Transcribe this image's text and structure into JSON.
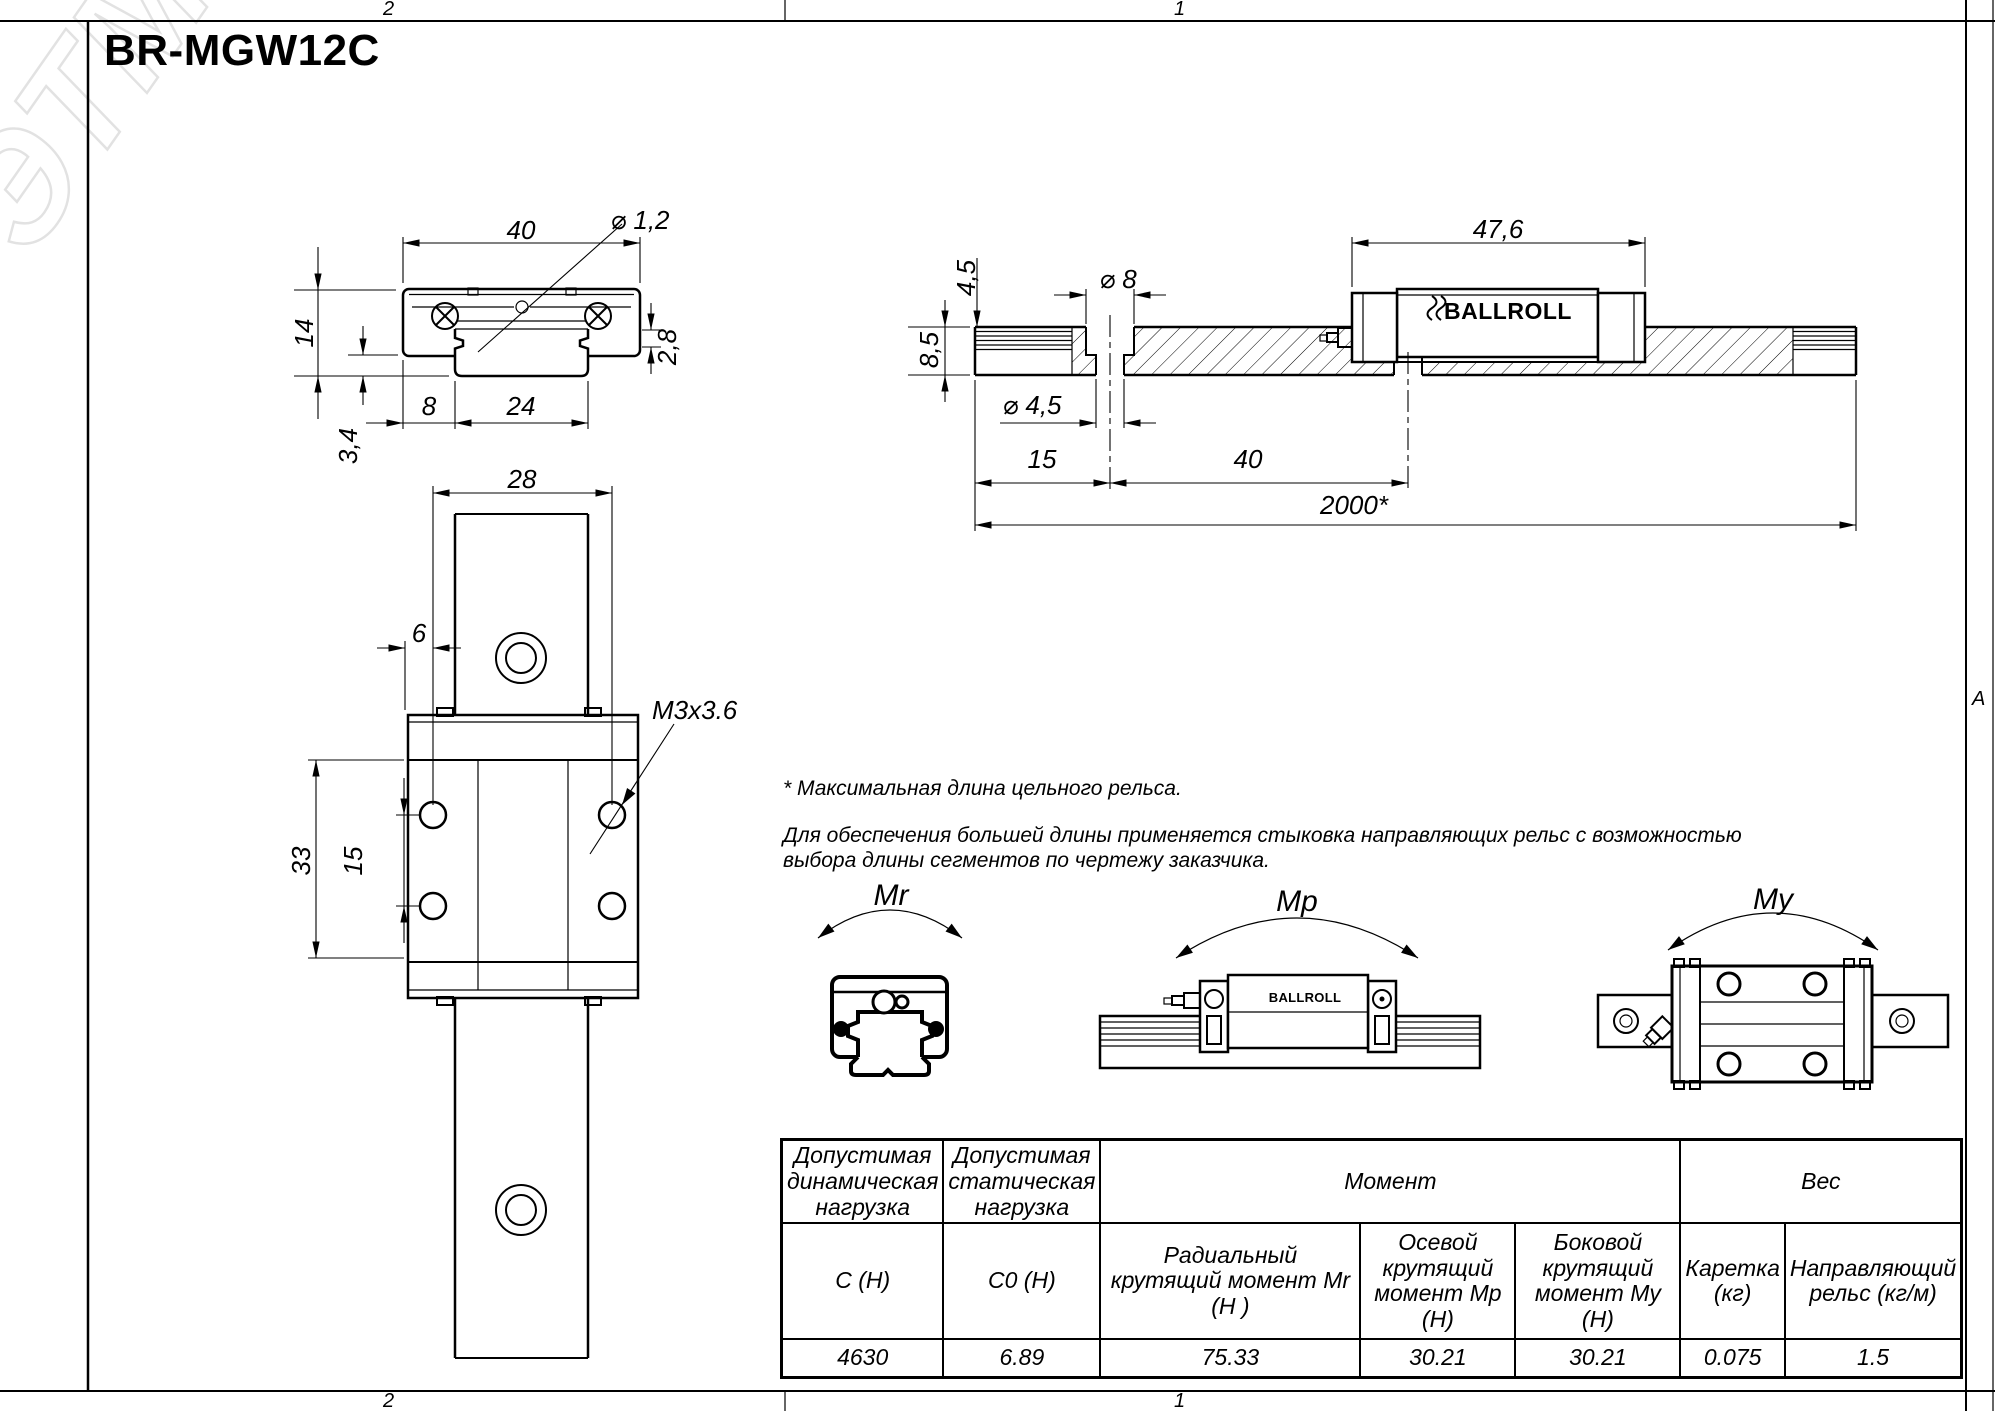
{
  "title": "BR-MGW12C",
  "watermark": "ЭТМ",
  "logo": "BALLROLL",
  "zones": {
    "top_left": "2",
    "top_right": "1",
    "bottom_left": "2",
    "bottom_right": "1",
    "right_marker": "A"
  },
  "dims": {
    "front": {
      "width": "40",
      "hole_dia": "⌀ 1,2",
      "height": "14",
      "race_height": "2,8",
      "offset": "8",
      "rail_width": "24",
      "foot_height": "3,4"
    },
    "plan": {
      "hole_pitch_w": "28",
      "edge_offset": "6",
      "thread": "M3x3.6",
      "length_pitch": "33",
      "hole_pitch_l": "15"
    },
    "side": {
      "carriage_length": "47,6",
      "cbore_depth": "4,5",
      "cbore_dia": "⌀ 8",
      "rail_height": "8,5",
      "hole_dia": "⌀ 4,5",
      "end_offset": "15",
      "hole_pitch": "40",
      "rail_length": "2000*"
    }
  },
  "moments": {
    "mr": "Mr",
    "mp": "Mp",
    "my": "My"
  },
  "notes": {
    "star": "* Максимальная длина цельного рельса.",
    "body_line1": "Для обеспечения большей длины применяется стыковка направляющих рельс с возможностью",
    "body_line2": "выбора длины сегментов по чертежу заказчика."
  },
  "table": {
    "headers": {
      "dynamic_load": "Допустимая динамическая нагрузка",
      "static_load": "Допустимая статическая нагрузка",
      "moment": "Момент",
      "weight": "Вес"
    },
    "subheaders": {
      "c": "C (Н)",
      "c0": "C0 (Н)",
      "mr": "Радиальный крутящий момент Mr (Н )",
      "mp": "Осевой крутящий момент Mp (Н)",
      "my": "Боковой крутящий момент My (Н)",
      "carriage": "Каретка (кг)",
      "rail": "Направляющий рельс (кг/м)"
    },
    "values": {
      "c": "4630",
      "c0": "6.89",
      "mr": "75.33",
      "mp": "30.21",
      "my": "30.21",
      "carriage": "0.075",
      "rail": "1.5"
    }
  }
}
